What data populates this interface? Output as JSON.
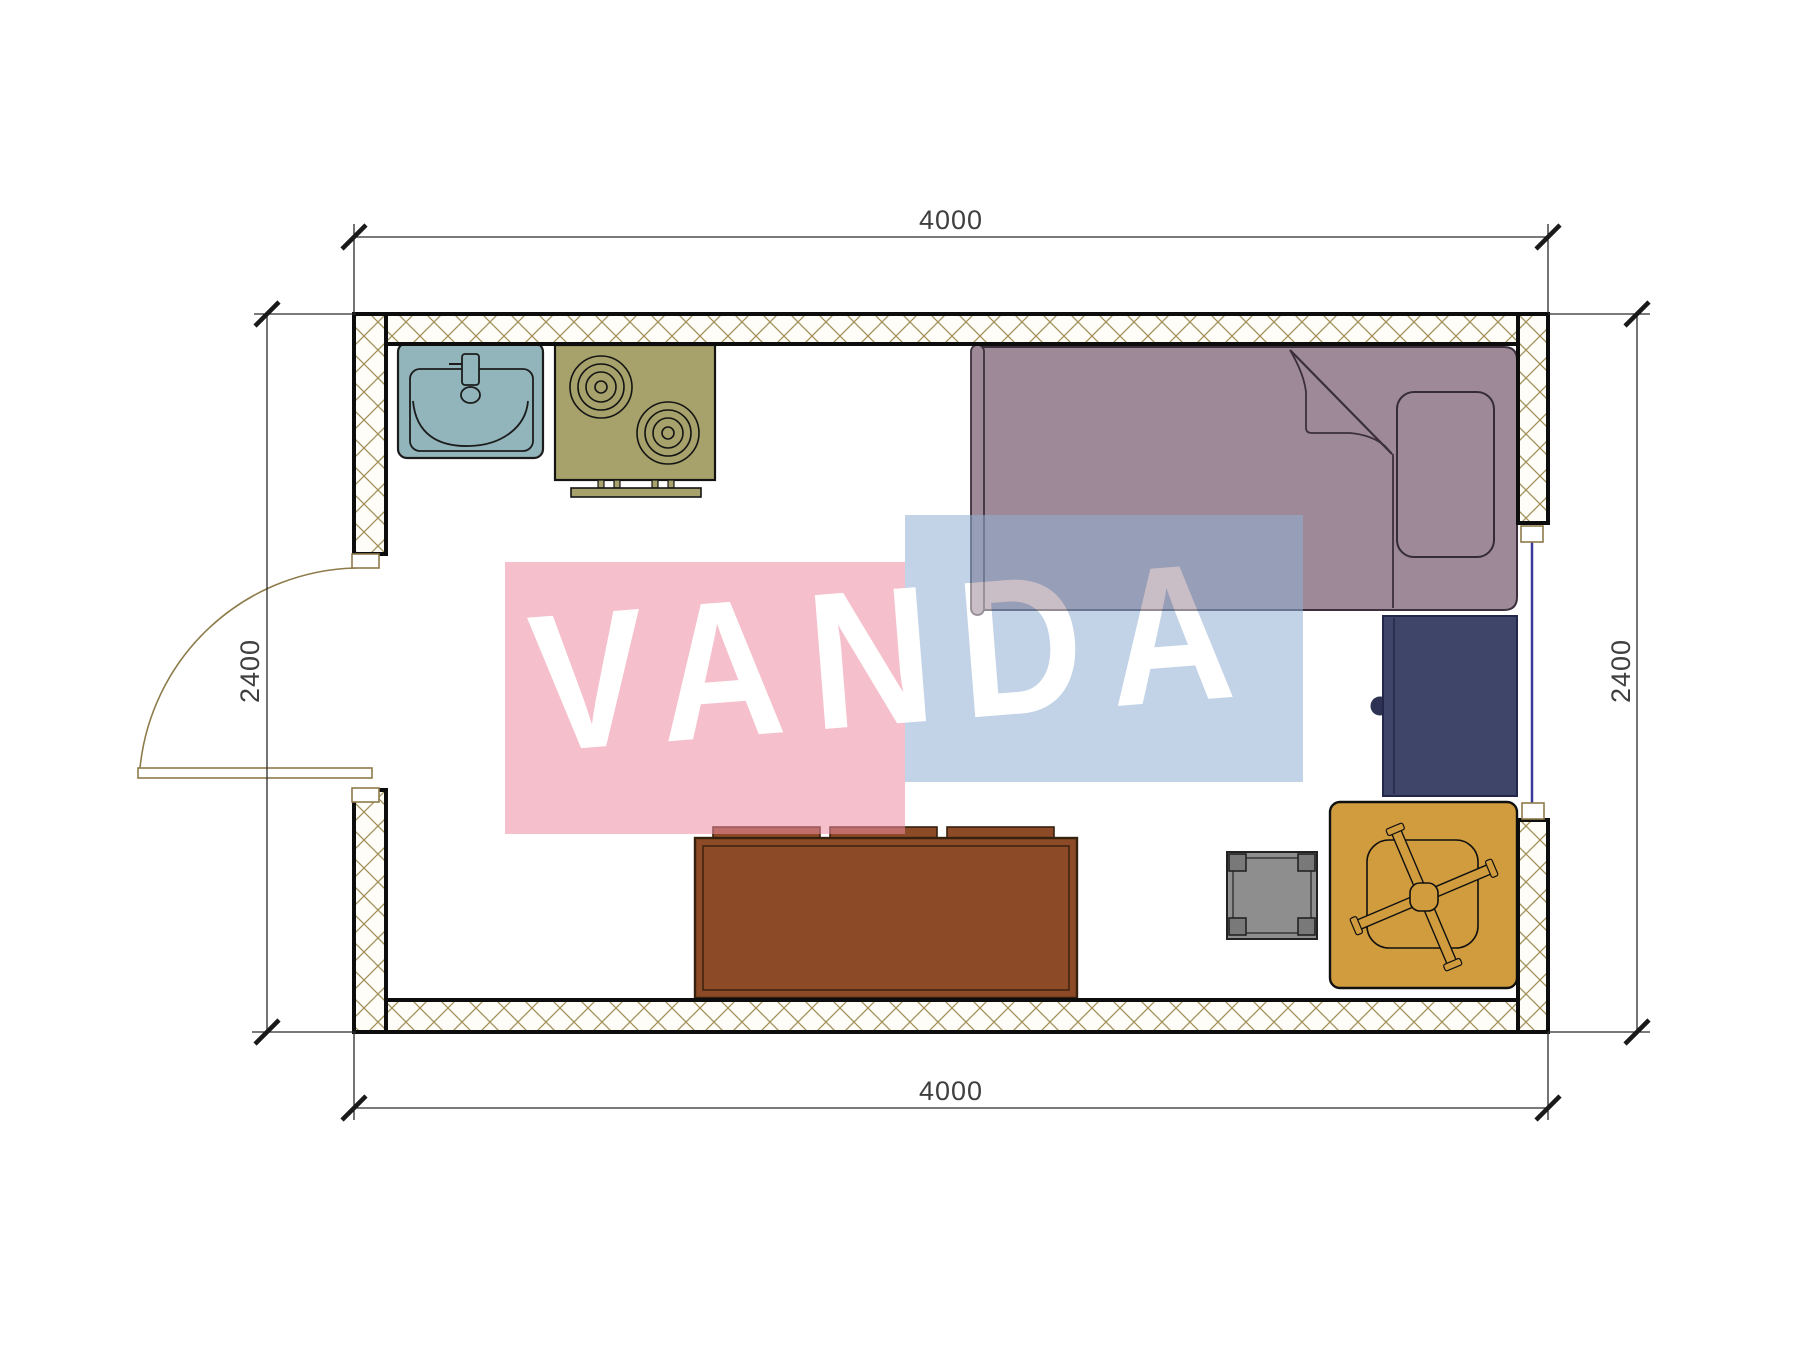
{
  "drawing": {
    "type": "architectural-floor-plan",
    "dimensions": {
      "top": "4000",
      "bottom": "4000",
      "left": "2400",
      "right": "2400"
    },
    "watermark": {
      "text": "VANDA",
      "pink": "#ec8ba0",
      "blue": "#90aed4"
    },
    "colors": {
      "wall_line": "#0d0d0d",
      "wall_hatch": "#a1905a",
      "sink": "#92b5bb",
      "stove": "#a7a26b",
      "bed": "#9d8997",
      "desk": "#3e4568",
      "sofa": "#8c4a26",
      "stool": "#8e8e8e",
      "chair": "#d09c3e",
      "door": "#8d7b4a",
      "window_glass": "#3a3a9a"
    },
    "elements": [
      "kitchen-sink",
      "cooktop-stove",
      "single-bed-with-pillow",
      "bedside-desk",
      "sofa-cabinet",
      "stool",
      "chair-with-fan",
      "entry-door",
      "window"
    ]
  }
}
